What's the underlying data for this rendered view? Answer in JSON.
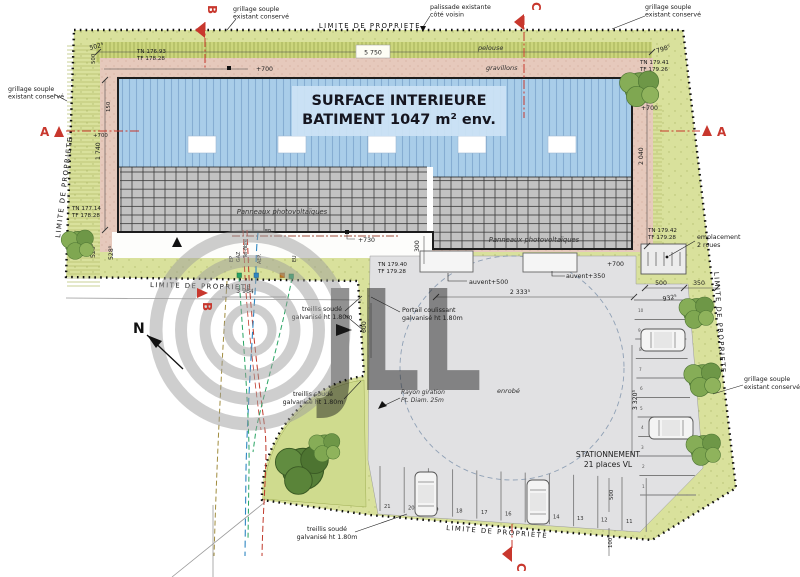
{
  "plan": {
    "watermark": "JLL",
    "surface_line1": "SURFACE INTERIEURE",
    "surface_line2": "BATIMENT 1047 m² env.",
    "pv_label": "Panneaux photovoltaïques",
    "north_label": "N"
  },
  "labels": {
    "limite": "LIMITE DE PROPRIETE",
    "grillage_1": "grillage souple",
    "grillage_2": "existant conservé",
    "palissade_1": "palissade existante",
    "palissade_2": "côté voisin",
    "pelouse": "pelouse",
    "gravillons": "gravillons",
    "enrobe": "enrobé",
    "treillis_1": "treillis soudé",
    "treillis_2": "galvanisé ht 1.80m",
    "portail_1": "Portail coulissant",
    "portail_2": "galvanisé ht 1.80m",
    "rayon_1": "Rayon giration",
    "rayon_2": "Pt. Diam. 25m",
    "stationnement_1": "STATIONNEMENT",
    "stationnement_2": "21 places VL",
    "emplacement_1": "emplacement",
    "emplacement_2": "2 roues"
  },
  "levels": {
    "tl_tn": "TN 176.93",
    "tl_tf": "TF 178.28",
    "tr_tn": "TN 179.41",
    "tr_tf": "TF 179.26",
    "ml_tn": "TN 177.14",
    "ml_tf": "TF 178.28",
    "c_tn": "TN 179.40",
    "c_tf": "TF 179.28",
    "mr_tn": "TN 179.42",
    "mr_tf": "TF 179.28"
  },
  "dims": {
    "d502": "502⁵",
    "d500v": "500",
    "d5750": "5 750",
    "d798": "798⁵",
    "d1740": "1 740",
    "d2040": "2 040",
    "d529": "529⁵",
    "d528": "528⁵",
    "d3964": "3 964",
    "d600": "600",
    "d300": "300",
    "d2333": "2 333⁵",
    "d150": "150",
    "d500r": "500",
    "d350": "350",
    "d932": "932⁵",
    "d3320": "3 320⁵",
    "d500b": "500",
    "d100": "100",
    "p700a": "+700",
    "p700b": "+700",
    "p700c": "+700",
    "p700d": "+700",
    "p730": "+730",
    "auvent500": "auvent+500",
    "auvent350": "auvent+350"
  },
  "utilities": {
    "ep": "EP",
    "gaz": "GAZ",
    "telfibre": "Tel-fibre",
    "aep": "AEP.",
    "eu": "EU"
  },
  "sections": {
    "a": "A",
    "b": "B",
    "c": "C"
  },
  "parking": {
    "bottom": [
      "21",
      "20",
      "19",
      "18",
      "17",
      "16",
      "15",
      "14",
      "13",
      "12",
      "11"
    ],
    "right": [
      "10",
      "9",
      "8",
      "7",
      "6",
      "5",
      "4",
      "3",
      "2",
      "1"
    ]
  },
  "colors": {
    "section_red": "#c8372d",
    "roof_blue": "#a9cde9",
    "lawn_green": "#d9e19c",
    "gravel_pink": "#e6c9bc",
    "asphalt_gray": "#e1e1e3"
  }
}
